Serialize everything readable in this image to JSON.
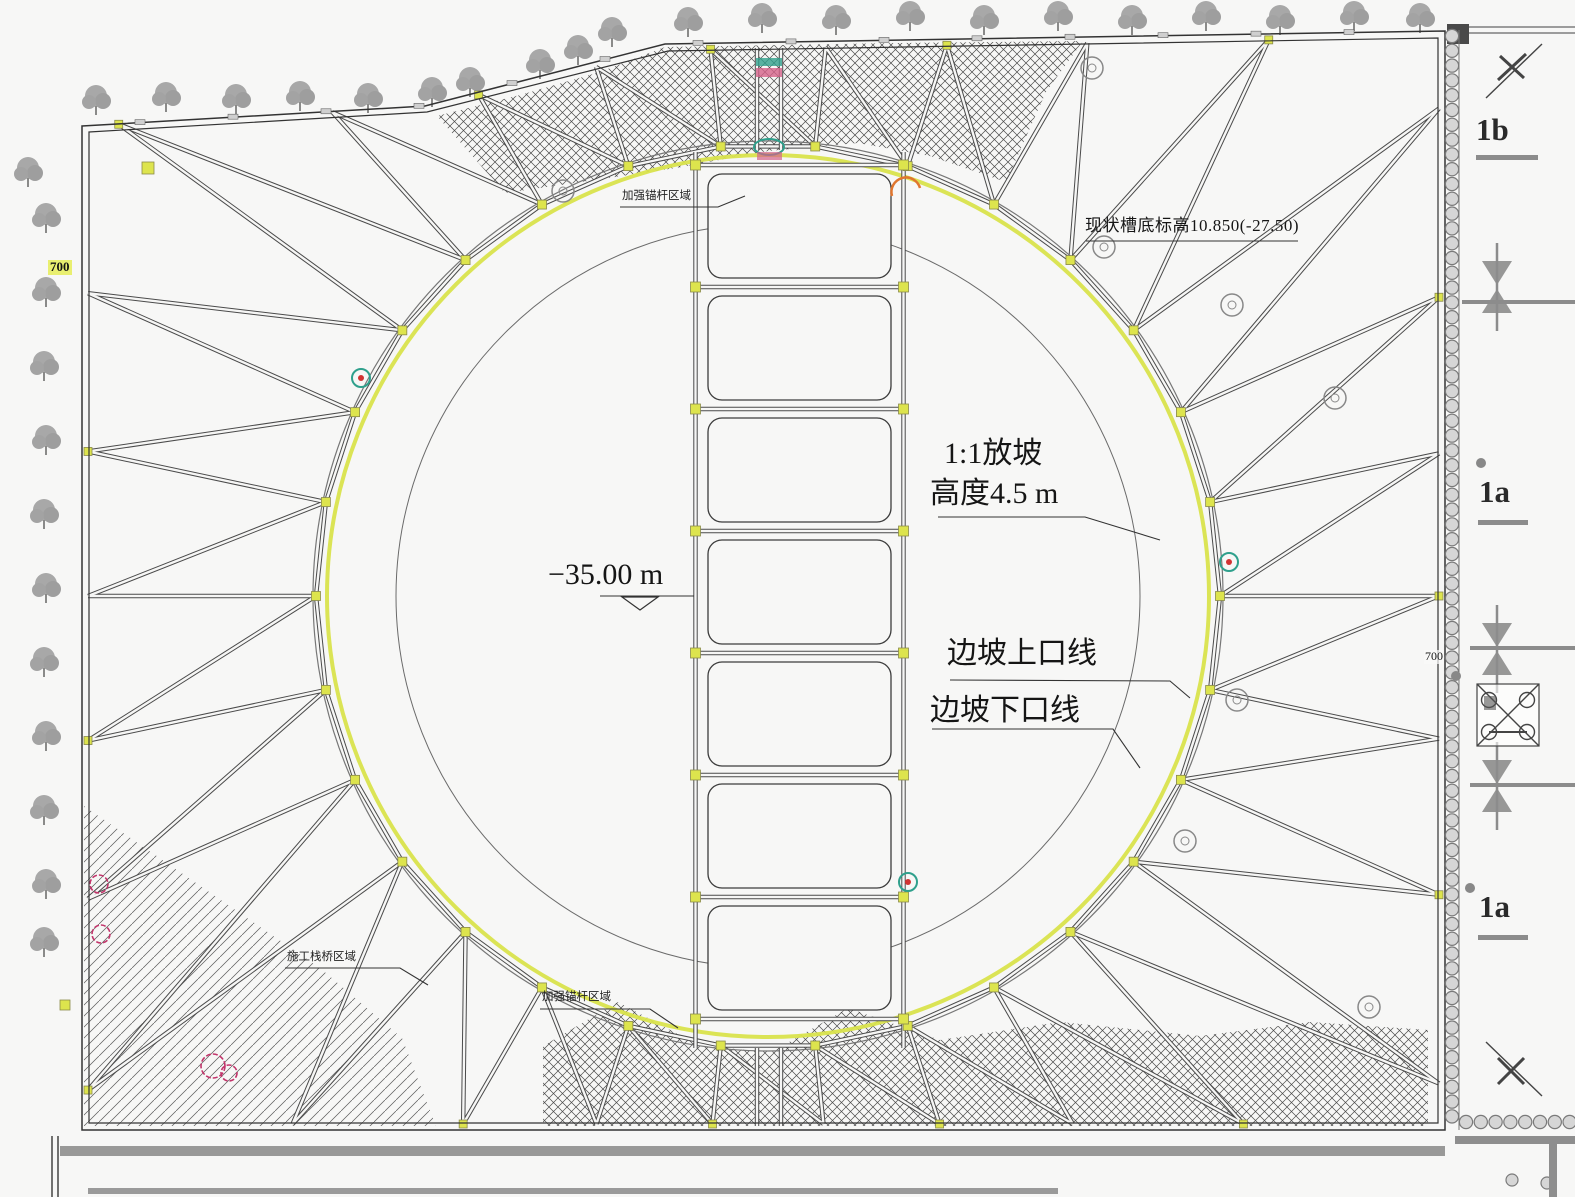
{
  "annotations": {
    "elev_note": "现状槽底标高10.850(-27.50)",
    "slope_ratio": "1:1放坡",
    "slope_height": "高度4.5 m",
    "pit_depth": "−35.00 m",
    "slope_top_line": "边坡上口线",
    "slope_bottom_line": "边坡下口线",
    "anchor_zone_top": "加强锚杆区域",
    "trestle_zone": "施工栈桥区域",
    "anchor_zone_bottom": "加强锚杆区域",
    "dim_700_left": "700",
    "dim_700_right": "700"
  },
  "sections": {
    "s1b": "1b",
    "s1a_top": "1a",
    "s1a_bottom": "1a"
  },
  "colors": {
    "slope_line": "#d9e34c",
    "node": "#dde44d",
    "strut": "#4a4a4a",
    "strut_core": "#f6f6f5",
    "revision_cloud": "#c2356b",
    "survey_teal": "#2fa08c",
    "survey_orange": "#e0762e",
    "tree": "#9b9b9b",
    "pile_fill": "#d6d6d6",
    "section_gray": "#8c8c8c"
  }
}
